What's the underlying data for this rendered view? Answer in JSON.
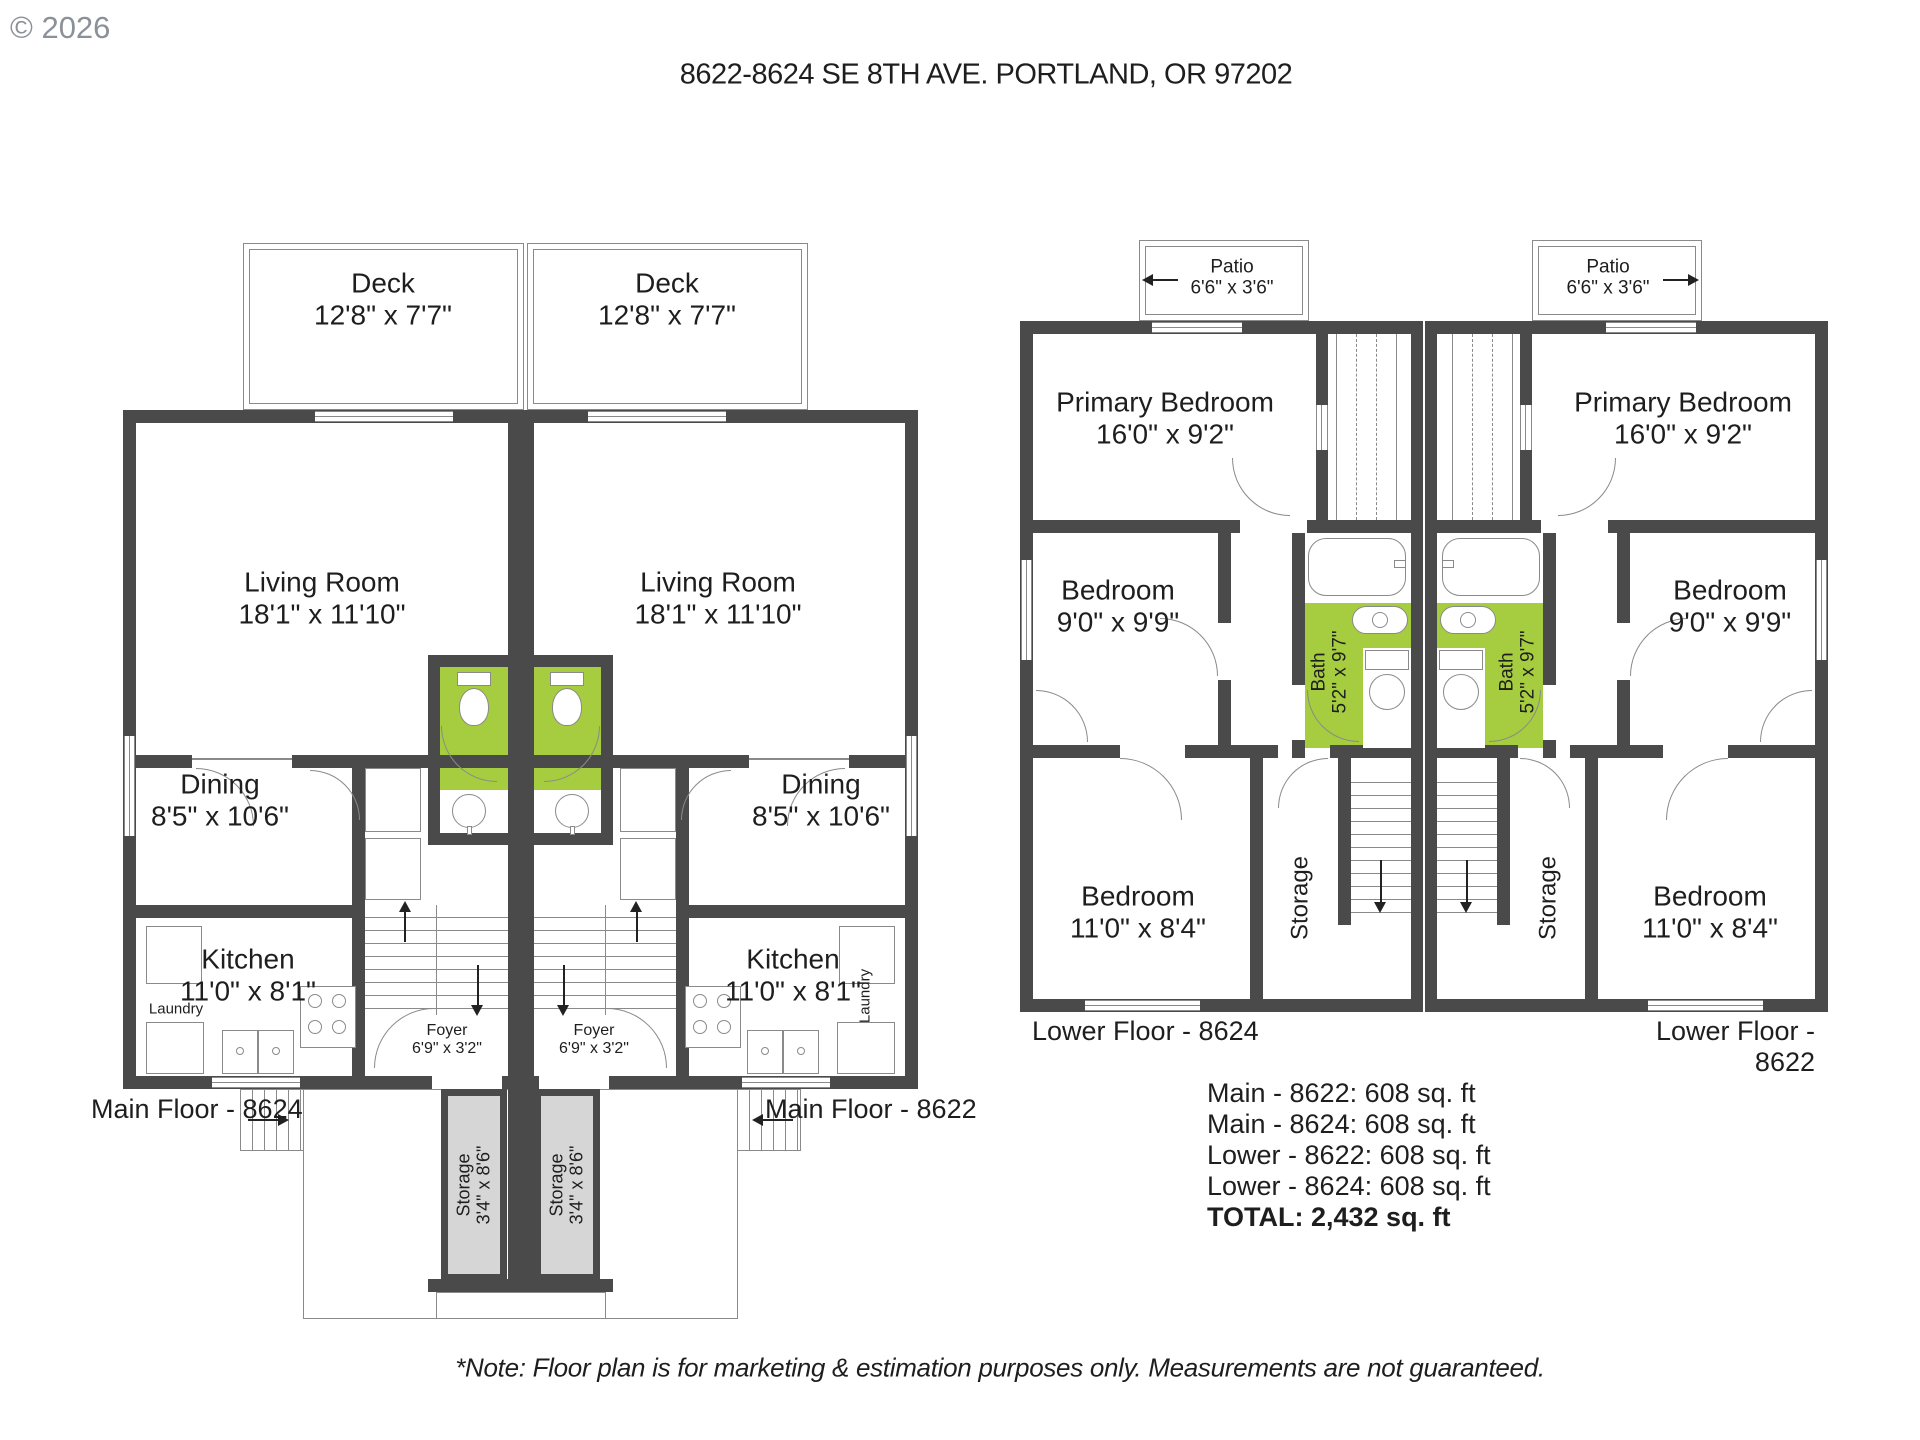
{
  "watermark": "© 2026",
  "title": "8622-8624 SE 8TH AVE. PORTLAND, OR 97202",
  "colors": {
    "wall": "#4a4a4a",
    "bath_green": "#a6cc40",
    "storage_fill": "#d6d6d6",
    "line_gray": "#8a8a8a",
    "text": "#1e1e1e",
    "watermark_gray": "#8a9199"
  },
  "main_floor": {
    "deck": {
      "name": "Deck",
      "dims": "12'8\" x 7'7\""
    },
    "living_room": {
      "name": "Living Room",
      "dims": "18'1\" x 11'10\""
    },
    "dining": {
      "name": "Dining",
      "dims": "8'5\" x 10'6\""
    },
    "kitchen": {
      "name": "Kitchen",
      "dims": "11'0\" x 8'1\""
    },
    "laundry": {
      "name": "Laundry"
    },
    "foyer": {
      "name": "Foyer",
      "dims": "6'9\" x 3'2\""
    },
    "storage": {
      "name": "Storage",
      "dims": "3'4\" x 8'6\""
    },
    "floor_label_left": "Main Floor - 8624",
    "floor_label_right": "Main Floor - 8622"
  },
  "lower_floor": {
    "patio": {
      "name": "Patio",
      "dims": "6'6\" x 3'6\""
    },
    "primary_bedroom": {
      "name": "Primary Bedroom",
      "dims": "16'0\" x 9'2\""
    },
    "bedroom_9": {
      "name": "Bedroom",
      "dims": "9'0\" x 9'9\""
    },
    "bath": {
      "name": "Bath",
      "dims": "5'2\" x 9'7\""
    },
    "bedroom_11": {
      "name": "Bedroom",
      "dims": "11'0\" x 8'4\""
    },
    "storage": {
      "name": "Storage"
    },
    "floor_label_left": "Lower Floor - 8624",
    "floor_label_right": "Lower Floor - 8622"
  },
  "summary": {
    "lines": [
      "Main - 8622: 608 sq. ft",
      "Main - 8624: 608 sq. ft",
      "Lower - 8622: 608 sq. ft",
      "Lower - 8624: 608 sq. ft"
    ],
    "total": "TOTAL: 2,432 sq. ft"
  },
  "note": "*Note: Floor plan is for marketing & estimation purposes only. Measurements are not guaranteed."
}
